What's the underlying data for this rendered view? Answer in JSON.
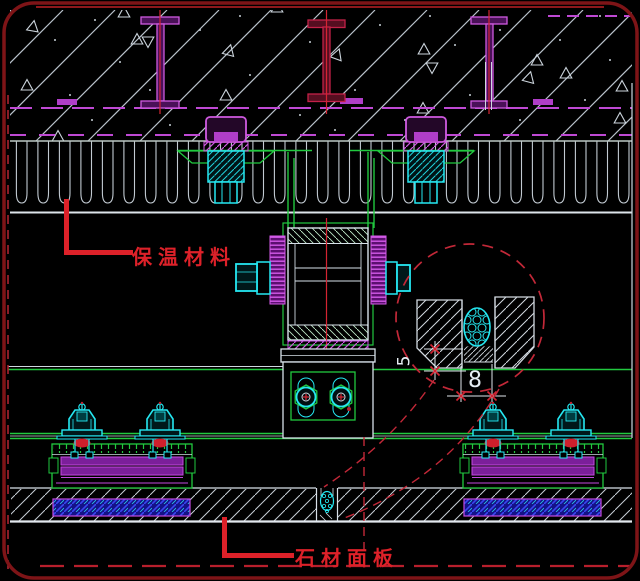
{
  "drawing": {
    "labels": {
      "insulation": "保温材料",
      "stone_panel": "石材面板"
    },
    "detail": {
      "sealant_depth_dim": "5",
      "joint_width_dim": "8"
    },
    "colors": {
      "background": "#000000",
      "border_red": "#7e1417",
      "annotation_red": "#dd2129",
      "callout_red": "#c22838",
      "green": "#21c93f",
      "cyan": "#25e8f2",
      "magenta": "#c44ae0",
      "crimson_steel": "#8c1430",
      "hatch_gray": "#b9c2cb",
      "deep_blue": "#141288"
    }
  }
}
